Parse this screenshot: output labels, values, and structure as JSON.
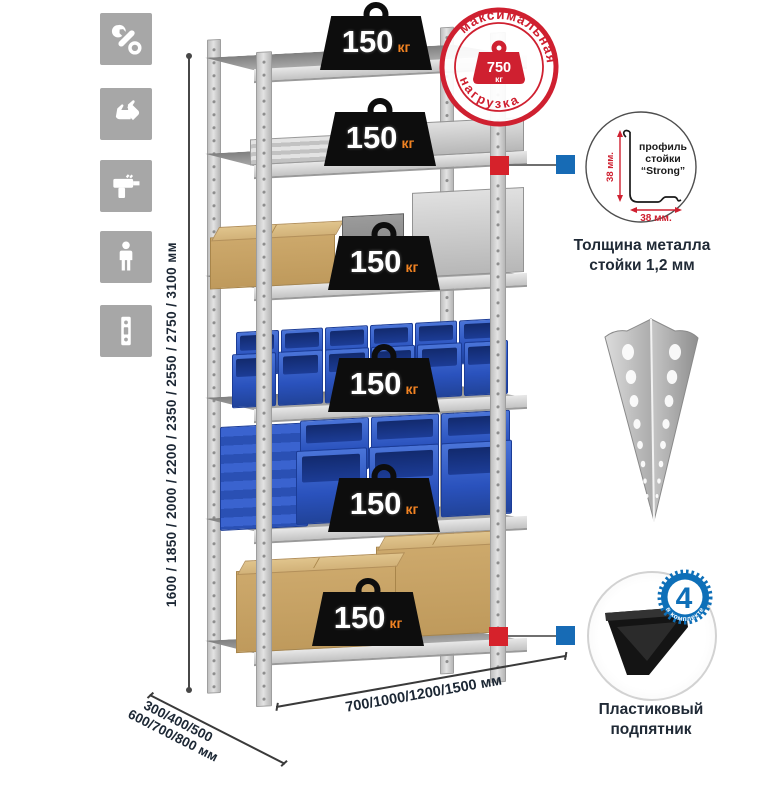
{
  "colors": {
    "accent_red": "#d6222b",
    "accent_blue": "#176bb5",
    "stamp_red": "#cf2030",
    "badge_orange": "#f08222",
    "text_dark": "#1c2734",
    "icon_gray": "#a7a7a7",
    "bin_blue": "#2a52bd"
  },
  "left_icons": [
    {
      "name": "wrench-icon"
    },
    {
      "name": "gloves-icon"
    },
    {
      "name": "drill-icon"
    },
    {
      "name": "person-icon"
    },
    {
      "name": "perforated-post-icon"
    }
  ],
  "height_dimension": {
    "label": "1600 / 1850 / 2000 / 2200 / 2350 / 2550 / 2750 / 3100 мм"
  },
  "shelf_badge": {
    "value": "150",
    "unit": "кг"
  },
  "shelves_count": 6,
  "max_load_stamp": {
    "arc_top": "максимальная",
    "arc_bottom": "нагрузка",
    "value": "750",
    "unit": "кг"
  },
  "profile_detail": {
    "title_line1": "профиль",
    "title_line2": "стойки",
    "title_line3": "“Strong”",
    "dim_vertical": "38 мм.",
    "dim_horizontal": "38 мм.",
    "caption_line1": "Толщина металла",
    "caption_line2": "стойки 1,2 мм"
  },
  "foot_detail": {
    "badge_value": "4",
    "badge_arc": "в комплекте",
    "caption_line1": "Пластиковый",
    "caption_line2": "подпятник"
  },
  "depth_dimension": {
    "line1": "300/400/500",
    "line2": "600/700/800 мм"
  },
  "width_dimension": {
    "label": "700/1000/1200/1500 мм"
  }
}
